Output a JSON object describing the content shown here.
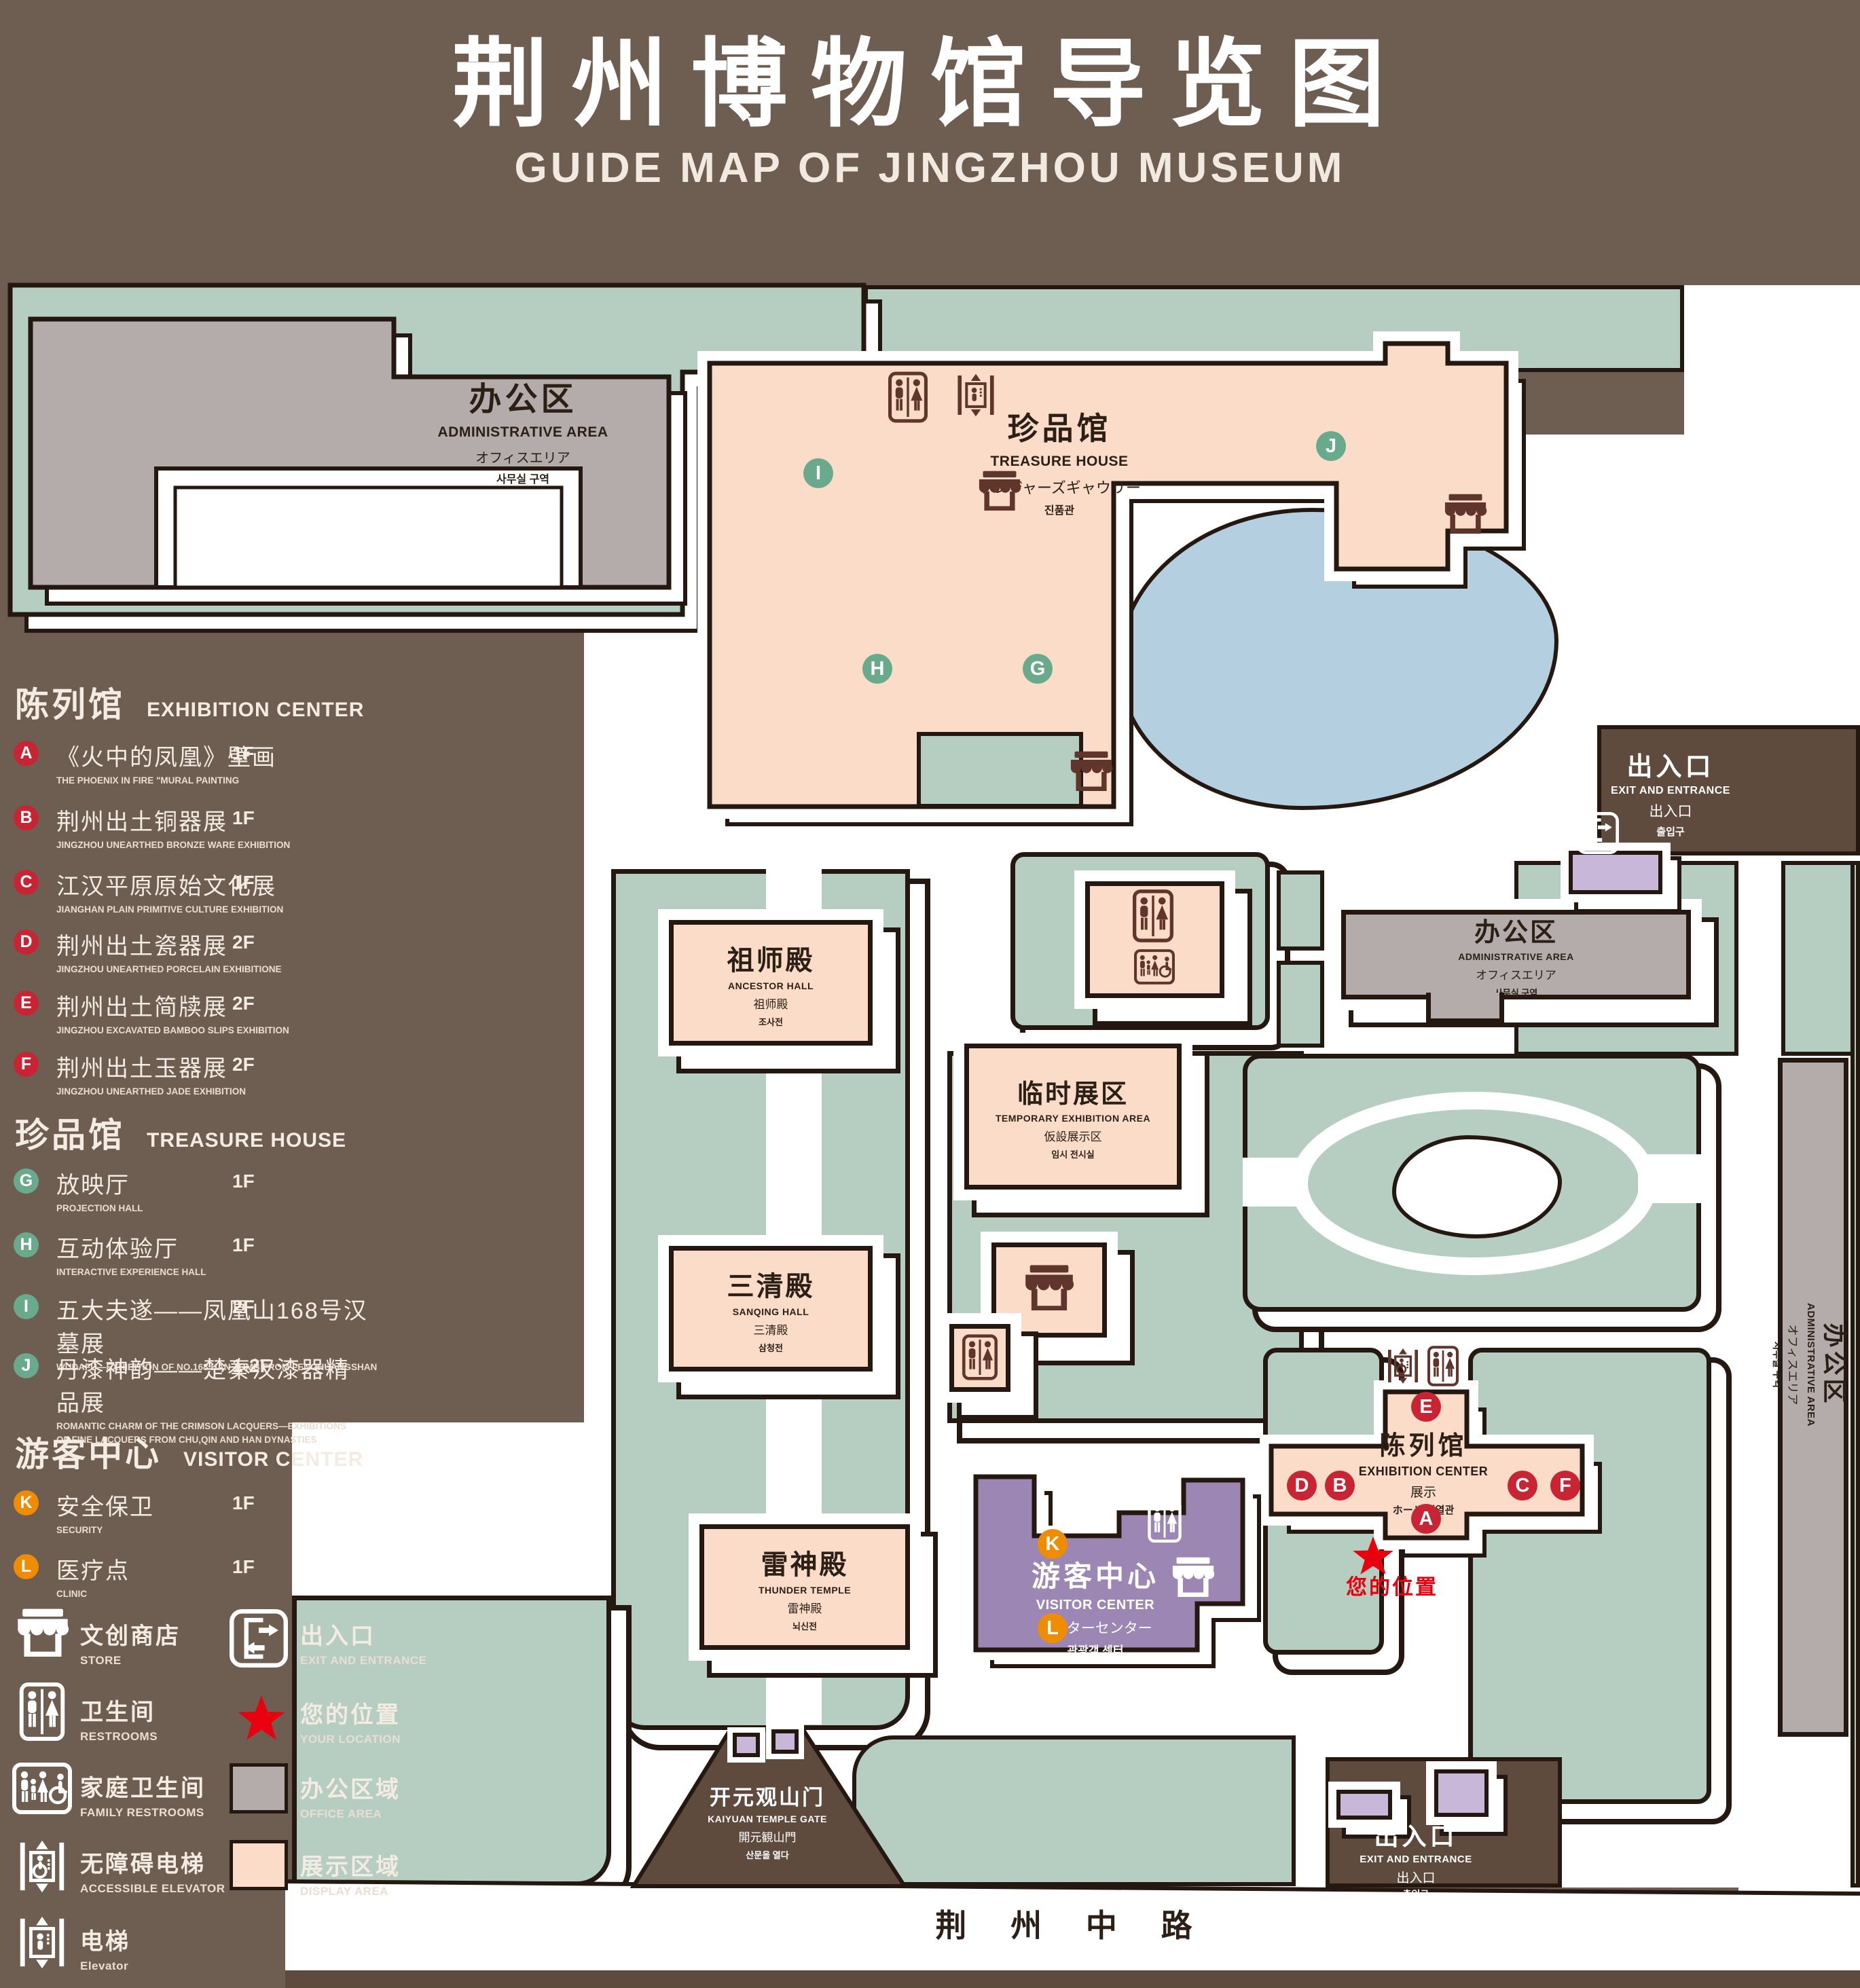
{
  "palette": {
    "background": "#6e5e51",
    "road": "#5e4b3e",
    "outline": "#241810",
    "courtyard_green": "#b5cec1",
    "display_area_pink": "#fadcc8",
    "office_area_gray": "#b3acaa",
    "visitor_purple": "#9c87b4",
    "small_building_purple": "#c9b7da",
    "lake_blue": "#b4cfe0",
    "marker_red": "#c92433",
    "marker_green": "#69aa8d",
    "marker_orange": "#f08c00",
    "star_red": "#e8000f",
    "icon_maroon": "#5f352c"
  },
  "header": {
    "title_zh": "荆州博物馆导览图",
    "title_en": "GUIDE MAP OF JINGZHOU MUSEUM"
  },
  "legend": {
    "sections": [
      {
        "title_zh": "陈列馆",
        "title_en": "EXHIBITION CENTER",
        "items": [
          {
            "letter": "A",
            "zh": "《火中的凤凰》壁画",
            "en": "THE PHOENIX IN FIRE \"MURAL PAINTING",
            "floor": "1F"
          },
          {
            "letter": "B",
            "zh": "荆州出土铜器展",
            "en": "JINGZHOU UNEARTHED BRONZE WARE EXHIBITION",
            "floor": "1F"
          },
          {
            "letter": "C",
            "zh": "江汉平原原始文化展",
            "en": "JIANGHAN PLAIN PRIMITIVE CULTURE EXHIBITION",
            "floor": "1F"
          },
          {
            "letter": "D",
            "zh": "荆州出土瓷器展",
            "en": "JINGZHOU UNEARTHED PORCELAIN EXHIBITIONE",
            "floor": "2F"
          },
          {
            "letter": "E",
            "zh": "荆州出土简牍展",
            "en": "JINGZHOU EXCAVATED BAMBOO SLIPS EXHIBITION",
            "floor": "2F"
          },
          {
            "letter": "F",
            "zh": "荆州出土玉器展",
            "en": "JINGZHOU UNEARTHED JADE EXHIBITION",
            "floor": "2F"
          }
        ]
      },
      {
        "title_zh": "珍品馆",
        "title_en": "TREASURE HOUSE",
        "items": [
          {
            "letter": "G",
            "zh": "放映厅",
            "en": "PROJECTION HALL",
            "floor": "1F"
          },
          {
            "letter": "H",
            "zh": "互动体验厅",
            "en": "INTERACTIVE EXPERIENCE HALL",
            "floor": "1F"
          },
          {
            "letter": "I",
            "zh": "五大夫遂——凤凰山168号汉墓展",
            "en": "WUDAFU—EXHIBITION OF NO.168 HAN TOMB FROM FENGHUANGSHAN",
            "floor": "2F"
          },
          {
            "letter": "J",
            "zh": "丹漆神韵——楚秦汉漆器精品展",
            "en": "ROMANTIC CHARM OF THE CRIMSON LACQUERS—EXHIBITIONS",
            "en2": "OF FINE LACQUERS FROM CHU,QIN AND HAN DYNASTIES",
            "floor": "1-2F"
          }
        ]
      },
      {
        "title_zh": "游客中心",
        "title_en": "VISITOR CENTER",
        "items": [
          {
            "letter": "K",
            "zh": "安全保卫",
            "en": "SECURITY",
            "floor": "1F"
          },
          {
            "letter": "L",
            "zh": "医疗点",
            "en": "CLINIC",
            "floor": "1F"
          }
        ]
      }
    ],
    "facilities_left": [
      {
        "icon": "store-icon",
        "zh": "文创商店",
        "en": "STORE"
      },
      {
        "icon": "restrooms-icon",
        "zh": "卫生间",
        "en": "RESTROOMS"
      },
      {
        "icon": "family-restrooms-icon",
        "zh": "家庭卫生间",
        "en": "FAMILY RESTROOMS"
      },
      {
        "icon": "accessible-elevator-icon",
        "zh": "无障碍电梯",
        "en": "ACCESSIBLE ELEVATOR"
      },
      {
        "icon": "elevator-icon",
        "zh": "电梯",
        "en": "Elevator"
      }
    ],
    "facilities_right": [
      {
        "icon": "exit-icon",
        "zh": "出入口",
        "en": "EXIT AND ENTRANCE"
      },
      {
        "icon": "location-star-icon",
        "zh": "您的位置",
        "en": "YOUR LOCATION"
      },
      {
        "icon": "office-area-swatch",
        "zh": "办公区域",
        "en": "OFFICE AREA"
      },
      {
        "icon": "display-area-swatch",
        "zh": "展示区域",
        "en": "DISPLAY AREA"
      }
    ]
  },
  "map": {
    "buildings": {
      "admin_tl": {
        "zh": "办公区",
        "en": "ADMINISTRATIVE AREA",
        "jp": "オフィスエリア",
        "kr": "사무실 구역"
      },
      "treasure": {
        "zh": "珍品馆",
        "en": "TREASURE HOUSE",
        "jp": "トレジャーズギャウリー",
        "kr": "진품관"
      },
      "ancestor": {
        "zh": "祖师殿",
        "en": "ANCESTOR HALL",
        "jp": "祖师殿",
        "kr": "조사전"
      },
      "temporary": {
        "zh": "临时展区",
        "en": "TEMPORARY EXHIBITION AREA",
        "jp": "仮設展示区",
        "kr": "임시 전시실"
      },
      "sanqing": {
        "zh": "三清殿",
        "en": "SANQING HALL",
        "jp": "三清殿",
        "kr": "삼청전"
      },
      "thunder": {
        "zh": "雷神殿",
        "en": "THUNDER TEMPLE",
        "jp": "雷神殿",
        "kr": "뇌신전"
      },
      "admin_right": {
        "zh": "办公区",
        "en": "ADMINISTRATIVE AREA",
        "jp": "オフィスエリア",
        "kr": "사무실 구역"
      },
      "admin_strip": {
        "zh": "办公区",
        "en": "ADMINISTRATIVE AREA",
        "jp": "オフィスエリア",
        "kr": "사무실 구역"
      },
      "exhibition": {
        "zh": "陈列馆",
        "en": "EXHIBITION CENTER",
        "jp": "展示",
        "kr": "ホール 진열관"
      },
      "visitor": {
        "zh": "游客中心",
        "en": "VISITOR CENTER",
        "jp": "ビジターセンター",
        "kr": "관광객 센터"
      },
      "gate": {
        "zh": "开元观山门",
        "en": "KAIYUAN TEMPLE GATE",
        "jp": "開元観山門",
        "kr": "산문을 열다"
      },
      "exit_top_right": {
        "zh": "出入口",
        "en": "EXIT AND ENTRANCE",
        "zh2": "出入口",
        "kr": "출입구"
      },
      "exit_bottom": {
        "zh": "出入口",
        "en": "EXIT AND ENTRANCE",
        "zh2": "出入口",
        "kr": "출입구"
      }
    },
    "road_label": "荆 州 中 路",
    "your_location": "您的位置",
    "markers": {
      "i": "I",
      "h": "H",
      "g": "G",
      "j": "J",
      "e": "E",
      "d": "D",
      "b": "B",
      "c": "C",
      "f": "F",
      "a": "A",
      "k": "K",
      "l": "L"
    }
  }
}
